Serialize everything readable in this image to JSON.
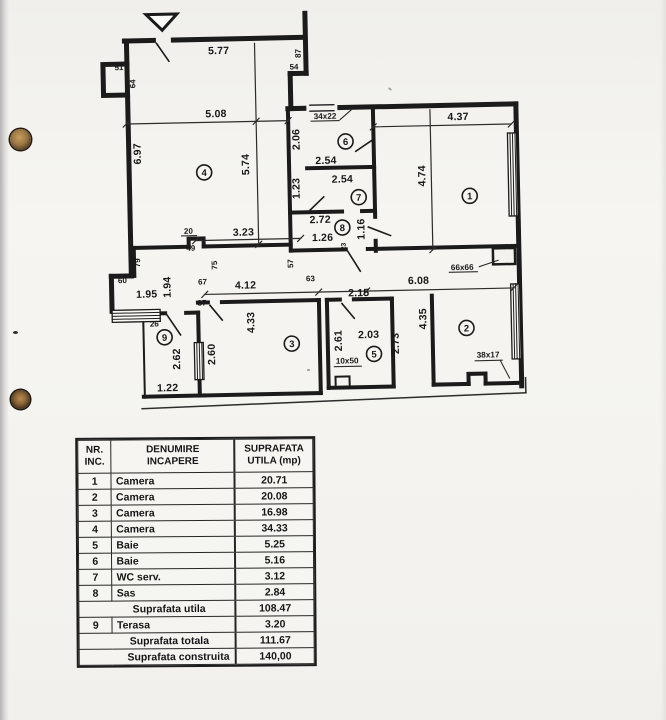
{
  "plan": {
    "labels": [
      "5.77",
      "87",
      "54",
      "51",
      "64",
      "5.08",
      "6.97",
      "5.74",
      "34x22",
      "2.06",
      "2.54",
      "4.37",
      "4.74",
      "2.54",
      "1.23",
      "2.72",
      "1.16",
      "1.26",
      "23",
      "20",
      "3.23",
      "49",
      "75",
      "57",
      "67",
      "63",
      "4.12",
      "1.94",
      "1.95",
      "60",
      "79",
      "37",
      "26",
      "66x66",
      "6.08",
      "2.15",
      "4.35",
      "2.61",
      "2.03",
      "2.73",
      "10x50",
      "38x17",
      "2.62",
      "2.60",
      "4.33",
      "1.22"
    ],
    "rooms": [
      "1",
      "2",
      "3",
      "4",
      "5",
      "6",
      "7",
      "8",
      "9"
    ]
  },
  "table": {
    "header": {
      "col1_line1": "NR.",
      "col1_line2": "INC.",
      "col2_line1": "DENUMIRE",
      "col2_line2": "INCAPERE",
      "col3_line1": "SUPRAFATA",
      "col3_line2": "UTILA  (mp)"
    },
    "rows": [
      {
        "nr": "1",
        "name": "Camera",
        "value": "20.71"
      },
      {
        "nr": "2",
        "name": "Camera",
        "value": "20.08"
      },
      {
        "nr": "3",
        "name": "Camera",
        "value": "16.98"
      },
      {
        "nr": "4",
        "name": "Camera",
        "value": "34.33"
      },
      {
        "nr": "5",
        "name": "Baie",
        "value": "5.25"
      },
      {
        "nr": "6",
        "name": "Baie",
        "value": "5.16"
      },
      {
        "nr": "7",
        "name": "WC serv.",
        "value": "3.12"
      },
      {
        "nr": "8",
        "name": "Sas",
        "value": "2.84"
      }
    ],
    "subtotal": {
      "label": "Suprafata utila",
      "value": "108.47"
    },
    "row9": {
      "nr": "9",
      "name": "Terasa",
      "value": "3.20"
    },
    "total": {
      "label": "Suprafata totala",
      "value": "111.67"
    },
    "built": {
      "label": "Suprafata construita",
      "value": "140,00"
    }
  }
}
